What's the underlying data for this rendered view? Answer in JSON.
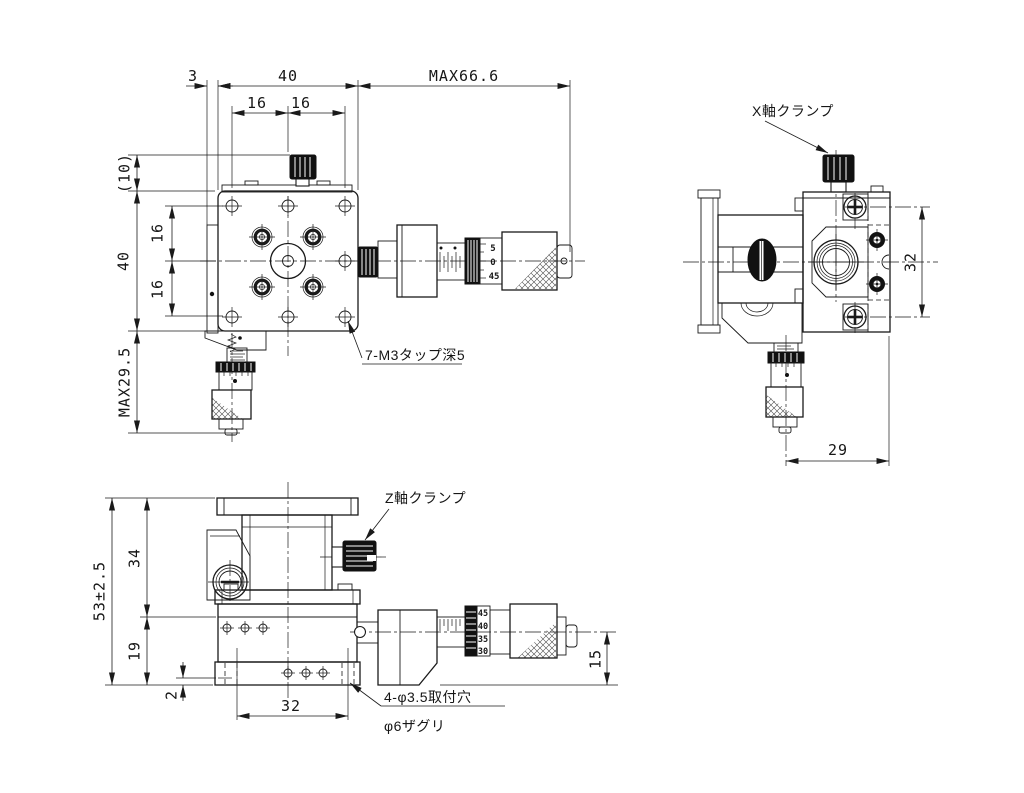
{
  "page": {
    "background": "#ffffff",
    "line_color": "#1a1a1a"
  },
  "views": {
    "front": {
      "dims": {
        "offset_3": "3",
        "width_40": "40",
        "max_travel_66": "MAX66.6",
        "pitch_16_left": "16",
        "pitch_16_right": "16",
        "knob_height_10": "(10)",
        "height_40": "40",
        "pitch_16_top": "16",
        "pitch_16_bottom": "16",
        "max_29_5": "MAX29.5"
      },
      "callout_tap": "7-M3タップ深5",
      "micrometer_scale": [
        "5",
        "0",
        "45"
      ]
    },
    "side": {
      "label_x_clamp": "X軸クランプ",
      "dims": {
        "height_32": "32",
        "depth_29": "29"
      }
    },
    "bottom": {
      "label_z_clamp": "Z軸クランプ",
      "dims": {
        "total_53": "53±2.5",
        "upper_34": "34",
        "lower_19": "19",
        "lip_2": "2",
        "pitch_32": "32",
        "axis_15": "15"
      },
      "callout_mount_line1": "4-φ3.5取付穴",
      "callout_mount_line2": "φ6ザグリ",
      "micrometer_scale": [
        "45",
        "40",
        "35",
        "30"
      ]
    }
  }
}
